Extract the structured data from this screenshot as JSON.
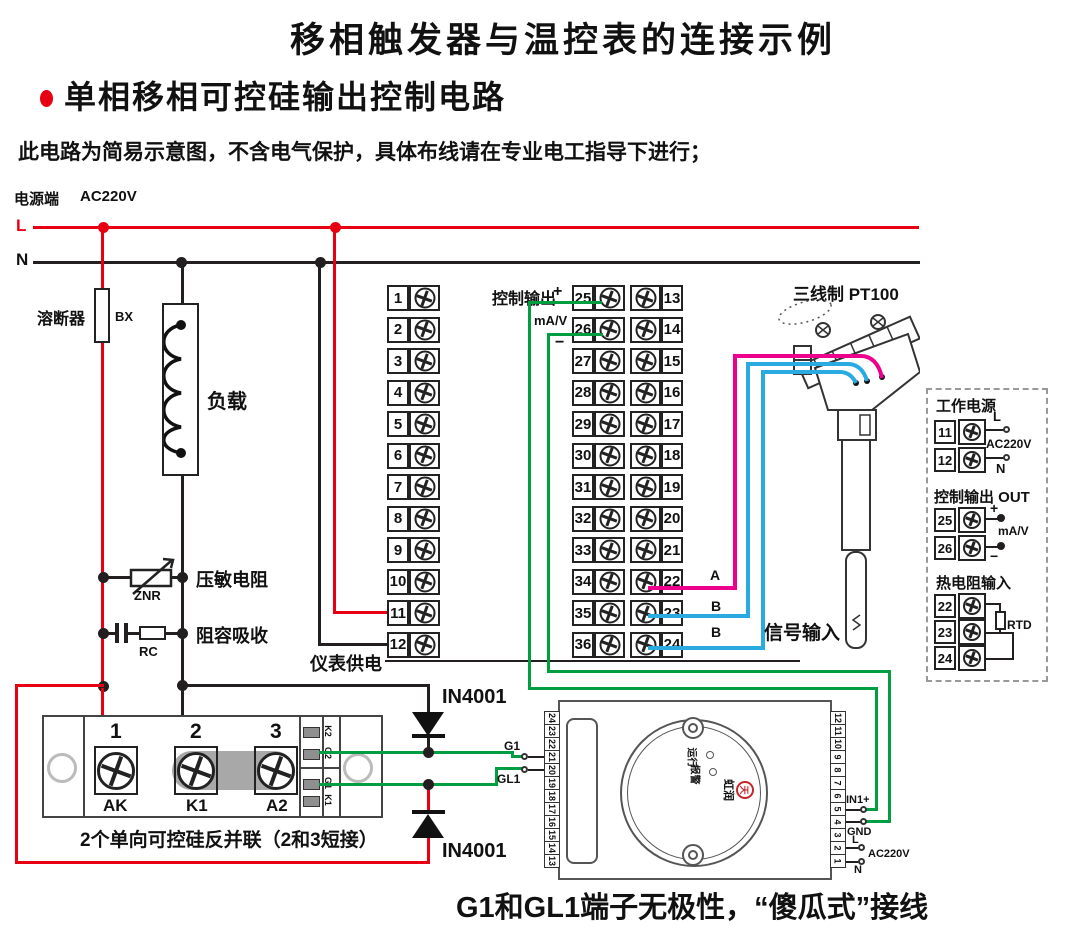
{
  "header": {
    "title": "移相触发器与温控表的连接示例",
    "subtitle": "单相移相可控硅输出控制电路",
    "note": "此电路为简易示意图，不含电气保护，具体布线请在专业电工指导下进行；"
  },
  "power": {
    "source_label": "电源端",
    "voltage": "AC220V",
    "l": "L",
    "n": "N"
  },
  "parts": {
    "fuse": "溶断器",
    "fuse_code": "BX",
    "load": "负载",
    "varistor": "压敏电阻",
    "varistor_code": "ZNR",
    "rc": "阻容吸收",
    "rc_code": "RC",
    "meter_supply": "仪表供电",
    "diode_top": "IN4001",
    "diode_bottom": "IN4001"
  },
  "controller": {
    "out_label": "控制输出",
    "plus": "+",
    "ma_v": "mA/V",
    "minus": "−",
    "left": [
      "1",
      "2",
      "3",
      "4",
      "5",
      "6",
      "7",
      "8",
      "9",
      "10",
      "11",
      "12"
    ],
    "mid": [
      "25",
      "26",
      "27",
      "28",
      "29",
      "30",
      "31",
      "32",
      "33",
      "34",
      "35",
      "36"
    ],
    "right": [
      "13",
      "14",
      "15",
      "16",
      "17",
      "18",
      "19",
      "20",
      "21",
      "22",
      "23",
      "24"
    ]
  },
  "sensor": {
    "title": "三线制 PT100",
    "a": "A",
    "b1": "B",
    "b2": "B",
    "signal": "信号输入"
  },
  "scr": {
    "nums": [
      "1",
      "2",
      "3"
    ],
    "pads": [
      "AK",
      "K1",
      "A2"
    ],
    "gates": [
      "K2",
      "G2",
      "G1",
      "K1"
    ],
    "caption": "2个单向可控硅反并联（2和3短接）"
  },
  "trigger": {
    "left_strip": [
      "24",
      "23",
      "22",
      "21",
      "20",
      "19",
      "18",
      "17",
      "16",
      "15",
      "14",
      "13"
    ],
    "right_strip": [
      "12",
      "11",
      "10",
      "9",
      "8",
      "7",
      "6",
      "5",
      "4",
      "3",
      "2",
      "1"
    ],
    "g1": "G1",
    "gl1": "GL1",
    "in1": "IN1+",
    "gnd": "GND",
    "l": "L",
    "ac": "AC220V",
    "n": "N",
    "run": "运行",
    "alarm": "报警",
    "logo": "虹润",
    "seal": "天"
  },
  "panel": {
    "work_power": "工作电源",
    "n11": "11",
    "n12": "12",
    "l": "L",
    "ac": "AC220V",
    "n": "N",
    "ctrl_out": "控制输出 OUT",
    "n25": "25",
    "n26": "26",
    "plus": "+",
    "minus": "−",
    "ma_v": "mA/V",
    "rtd_in": "热电阻输入",
    "n22": "22",
    "n23": "23",
    "n24": "24",
    "rtd": "RTD"
  },
  "footer": {
    "note": "G1和GL1端子无极性，“傻瓜式”接线"
  },
  "colors": {
    "live": "#e60012",
    "neutral": "#231f20",
    "signal_green": "#009e40",
    "wire_a_pink": "#ec008c",
    "wire_b_blue": "#29abe2",
    "logo_red": "#c4272c"
  }
}
